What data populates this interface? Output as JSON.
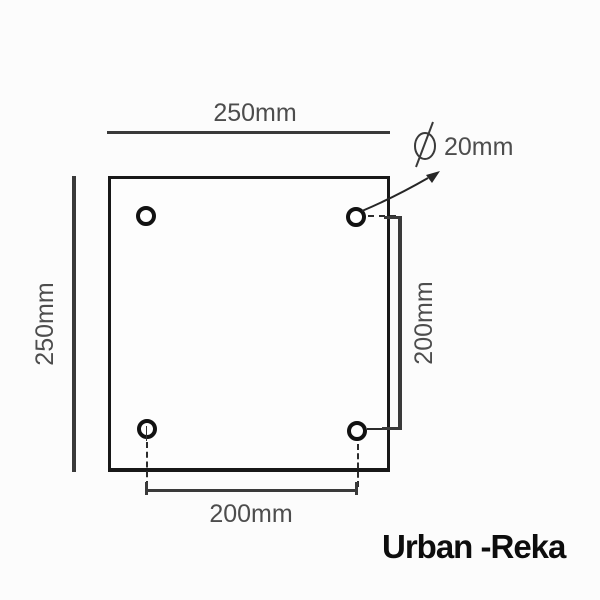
{
  "diagram": {
    "plate": {
      "width_label": "250mm",
      "height_label": "250mm"
    },
    "holes": {
      "count": 4,
      "diameter_symbol": "⌀",
      "diameter_label": "20mm",
      "spacing_horizontal_label": "200mm",
      "spacing_vertical_label": "200mm"
    },
    "colors": {
      "background": "#fcfcfc",
      "plate_outline": "#181818",
      "dimension_lines": "#3a3a3a",
      "dimension_text": "#4d4d4d"
    }
  },
  "brand": {
    "name": "Urban -Reka",
    "color": "#0d0d0d"
  }
}
